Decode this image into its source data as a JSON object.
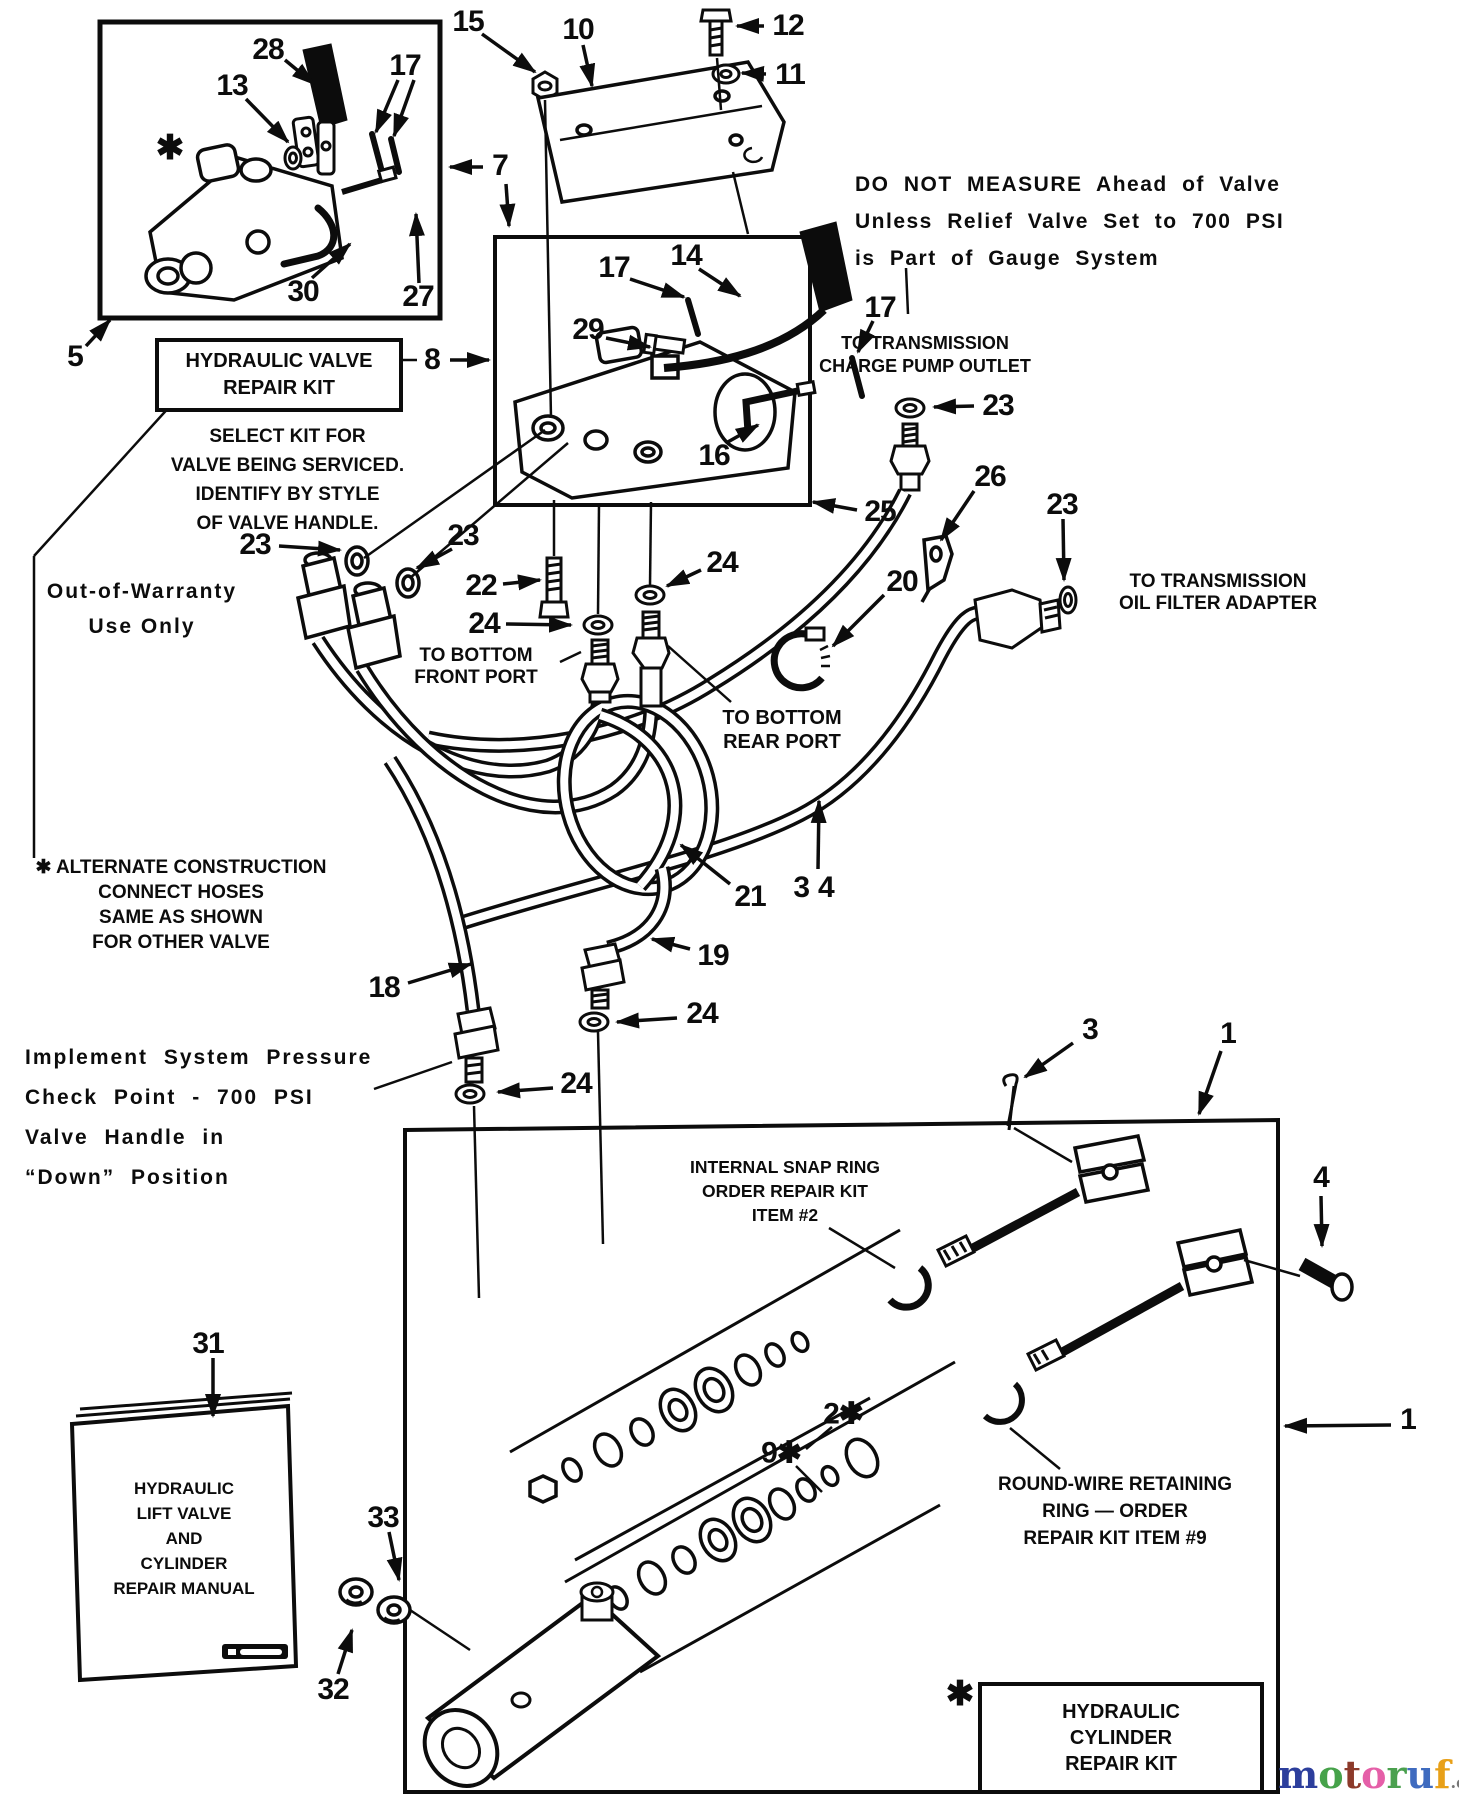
{
  "notes": {
    "do_not_measure": [
      "DO NOT MEASURE Ahead of Valve",
      "Unless Relief Valve Set to 700 PSI",
      "is Part of Gauge System"
    ],
    "charge_pump": [
      "TO TRANSMISSION",
      "CHARGE PUMP OUTLET"
    ],
    "oil_filter": [
      "TO TRANSMISSION",
      "OIL FILTER ADAPTER"
    ],
    "front_port": [
      "TO BOTTOM",
      "FRONT PORT"
    ],
    "rear_port": [
      "TO BOTTOM",
      "REAR PORT"
    ],
    "select_kit": [
      "SELECT KIT FOR",
      "VALVE BEING SERVICED.",
      "IDENTIFY BY STYLE",
      "OF VALVE HANDLE."
    ],
    "alternate": [
      "✱ ALTERNATE CONSTRUCTION",
      "CONNECT HOSES",
      "SAME AS SHOWN",
      "FOR OTHER VALVE"
    ],
    "out_of_warranty": [
      "Out-of-Warranty",
      "Use Only"
    ],
    "implement": [
      "Implement System Pressure",
      "Check Point - 700 PSI",
      "Valve Handle in",
      "“Down” Position"
    ],
    "snap_ring": [
      "INTERNAL SNAP RING",
      "ORDER REPAIR KIT",
      "ITEM #2"
    ],
    "round_wire": [
      "ROUND-WIRE RETAINING",
      "RING — ORDER",
      "REPAIR KIT ITEM #9"
    ]
  },
  "boxes": {
    "valve_repair_kit": [
      "HYDRAULIC VALVE",
      "REPAIR KIT"
    ],
    "cylinder_repair_kit": [
      "HYDRAULIC",
      "CYLINDER",
      "REPAIR KIT"
    ],
    "manual": [
      "HYDRAULIC",
      "LIFT VALVE",
      "AND",
      "CYLINDER",
      "REPAIR MANUAL"
    ]
  },
  "watermark": {
    "suffix": ".de",
    "letters": [
      {
        "ch": "m",
        "color": "#2c3e9c"
      },
      {
        "ch": "o",
        "color": "#46a24a"
      },
      {
        "ch": "t",
        "color": "#8c3a2a"
      },
      {
        "ch": "o",
        "color": "#e55fa8"
      },
      {
        "ch": "r",
        "color": "#4aa04e"
      },
      {
        "ch": "u",
        "color": "#3f6bbf"
      },
      {
        "ch": "f",
        "color": "#e8a018"
      }
    ]
  },
  "part_labels": [
    {
      "t": "28",
      "x": 268,
      "y": 50
    },
    {
      "t": "13",
      "x": 232,
      "y": 86
    },
    {
      "t": "17",
      "x": 405,
      "y": 66
    },
    {
      "t": "✱",
      "x": 170,
      "y": 148,
      "big": true
    },
    {
      "t": "30",
      "x": 303,
      "y": 292
    },
    {
      "t": "27",
      "x": 418,
      "y": 297
    },
    {
      "t": "5",
      "x": 75,
      "y": 357
    },
    {
      "t": "15",
      "x": 468,
      "y": 22
    },
    {
      "t": "10",
      "x": 578,
      "y": 30
    },
    {
      "t": "12",
      "x": 788,
      "y": 26
    },
    {
      "t": "11",
      "x": 790,
      "y": 75
    },
    {
      "t": "7",
      "x": 500,
      "y": 166
    },
    {
      "t": "8",
      "x": 432,
      "y": 360
    },
    {
      "t": "17",
      "x": 614,
      "y": 268
    },
    {
      "t": "14",
      "x": 686,
      "y": 256
    },
    {
      "t": "17",
      "x": 880,
      "y": 308
    },
    {
      "t": "29",
      "x": 588,
      "y": 330
    },
    {
      "t": "16",
      "x": 714,
      "y": 456
    },
    {
      "t": "23",
      "x": 998,
      "y": 406
    },
    {
      "t": "23",
      "x": 255,
      "y": 545
    },
    {
      "t": "23",
      "x": 463,
      "y": 536
    },
    {
      "t": "22",
      "x": 481,
      "y": 586
    },
    {
      "t": "24",
      "x": 722,
      "y": 563
    },
    {
      "t": "24",
      "x": 484,
      "y": 624
    },
    {
      "t": "25",
      "x": 880,
      "y": 512
    },
    {
      "t": "26",
      "x": 990,
      "y": 477
    },
    {
      "t": "23",
      "x": 1062,
      "y": 505
    },
    {
      "t": "20",
      "x": 902,
      "y": 582
    },
    {
      "t": "21",
      "x": 750,
      "y": 897
    },
    {
      "t": "34",
      "x": 818,
      "y": 888,
      "ls": 8
    },
    {
      "t": "19",
      "x": 713,
      "y": 956
    },
    {
      "t": "18",
      "x": 384,
      "y": 988
    },
    {
      "t": "24",
      "x": 702,
      "y": 1014
    },
    {
      "t": "24",
      "x": 576,
      "y": 1084
    },
    {
      "t": "3",
      "x": 1090,
      "y": 1030
    },
    {
      "t": "1",
      "x": 1228,
      "y": 1034
    },
    {
      "t": "4",
      "x": 1321,
      "y": 1178
    },
    {
      "t": "1",
      "x": 1408,
      "y": 1420
    },
    {
      "t": "2✱",
      "x": 843,
      "y": 1414
    },
    {
      "t": "9✱",
      "x": 781,
      "y": 1453
    },
    {
      "t": "31",
      "x": 208,
      "y": 1344
    },
    {
      "t": "33",
      "x": 383,
      "y": 1518
    },
    {
      "t": "32",
      "x": 333,
      "y": 1690
    },
    {
      "t": "✱",
      "x": 960,
      "y": 1694,
      "big": true
    }
  ],
  "leaders": {
    "arrows": [
      {
        "x1": 285,
        "y1": 60,
        "x2": 314,
        "y2": 84
      },
      {
        "x1": 246,
        "y1": 99,
        "x2": 288,
        "y2": 142
      },
      {
        "x1": 398,
        "y1": 80,
        "x2": 376,
        "y2": 132
      },
      {
        "x1": 414,
        "y1": 80,
        "x2": 394,
        "y2": 136
      },
      {
        "x1": 312,
        "y1": 278,
        "x2": 350,
        "y2": 244
      },
      {
        "x1": 419,
        "y1": 283,
        "x2": 416,
        "y2": 214
      },
      {
        "x1": 86,
        "y1": 346,
        "x2": 110,
        "y2": 320
      },
      {
        "x1": 482,
        "y1": 34,
        "x2": 535,
        "y2": 72
      },
      {
        "x1": 583,
        "y1": 45,
        "x2": 592,
        "y2": 86
      },
      {
        "x1": 764,
        "y1": 26,
        "x2": 737,
        "y2": 26
      },
      {
        "x1": 766,
        "y1": 74,
        "x2": 742,
        "y2": 73
      },
      {
        "x1": 483,
        "y1": 167,
        "x2": 450,
        "y2": 167
      },
      {
        "x1": 506,
        "y1": 184,
        "x2": 509,
        "y2": 226
      },
      {
        "x1": 450,
        "y1": 360,
        "x2": 489,
        "y2": 360
      },
      {
        "x1": 630,
        "y1": 279,
        "x2": 684,
        "y2": 297
      },
      {
        "x1": 699,
        "y1": 269,
        "x2": 740,
        "y2": 296
      },
      {
        "x1": 873,
        "y1": 321,
        "x2": 858,
        "y2": 352
      },
      {
        "x1": 606,
        "y1": 338,
        "x2": 650,
        "y2": 347
      },
      {
        "x1": 726,
        "y1": 443,
        "x2": 758,
        "y2": 425
      },
      {
        "x1": 974,
        "y1": 406,
        "x2": 934,
        "y2": 407
      },
      {
        "x1": 279,
        "y1": 546,
        "x2": 340,
        "y2": 550
      },
      {
        "x1": 452,
        "y1": 549,
        "x2": 417,
        "y2": 568
      },
      {
        "x1": 503,
        "y1": 584,
        "x2": 540,
        "y2": 580
      },
      {
        "x1": 701,
        "y1": 570,
        "x2": 667,
        "y2": 586
      },
      {
        "x1": 506,
        "y1": 624,
        "x2": 571,
        "y2": 625
      },
      {
        "x1": 857,
        "y1": 510,
        "x2": 813,
        "y2": 502
      },
      {
        "x1": 974,
        "y1": 491,
        "x2": 941,
        "y2": 540
      },
      {
        "x1": 1063,
        "y1": 519,
        "x2": 1064,
        "y2": 580
      },
      {
        "x1": 884,
        "y1": 595,
        "x2": 833,
        "y2": 646
      },
      {
        "x1": 730,
        "y1": 884,
        "x2": 681,
        "y2": 845
      },
      {
        "x1": 818,
        "y1": 869,
        "x2": 819,
        "y2": 801
      },
      {
        "x1": 690,
        "y1": 949,
        "x2": 652,
        "y2": 939
      },
      {
        "x1": 408,
        "y1": 983,
        "x2": 471,
        "y2": 964
      },
      {
        "x1": 677,
        "y1": 1018,
        "x2": 617,
        "y2": 1022
      },
      {
        "x1": 553,
        "y1": 1088,
        "x2": 498,
        "y2": 1092
      },
      {
        "x1": 1073,
        "y1": 1043,
        "x2": 1025,
        "y2": 1077
      },
      {
        "x1": 1221,
        "y1": 1051,
        "x2": 1199,
        "y2": 1114
      },
      {
        "x1": 1391,
        "y1": 1425,
        "x2": 1285,
        "y2": 1426
      },
      {
        "x1": 1321,
        "y1": 1196,
        "x2": 1322,
        "y2": 1246
      },
      {
        "x1": 213,
        "y1": 1358,
        "x2": 213,
        "y2": 1416
      },
      {
        "x1": 389,
        "y1": 1532,
        "x2": 399,
        "y2": 1580
      },
      {
        "x1": 338,
        "y1": 1674,
        "x2": 352,
        "y2": 1630
      }
    ],
    "lines": [
      {
        "x1": 545,
        "y1": 100,
        "x2": 551,
        "y2": 418
      },
      {
        "x1": 717,
        "y1": 58,
        "x2": 721,
        "y2": 110
      },
      {
        "x1": 733,
        "y1": 172,
        "x2": 748,
        "y2": 234
      },
      {
        "x1": 906,
        "y1": 268,
        "x2": 908,
        "y2": 314
      },
      {
        "x1": 172,
        "y1": 404,
        "x2": 34,
        "y2": 556
      },
      {
        "x1": 34,
        "y1": 556,
        "x2": 34,
        "y2": 858
      },
      {
        "x1": 397,
        "y1": 360,
        "x2": 417,
        "y2": 360
      },
      {
        "x1": 545,
        "y1": 430,
        "x2": 364,
        "y2": 558
      },
      {
        "x1": 568,
        "y1": 443,
        "x2": 410,
        "y2": 578
      },
      {
        "x1": 554,
        "y1": 500,
        "x2": 554,
        "y2": 556
      },
      {
        "x1": 599,
        "y1": 505,
        "x2": 598,
        "y2": 614
      },
      {
        "x1": 651,
        "y1": 502,
        "x2": 650,
        "y2": 586
      },
      {
        "x1": 560,
        "y1": 662,
        "x2": 581,
        "y2": 652
      },
      {
        "x1": 731,
        "y1": 702,
        "x2": 668,
        "y2": 646
      },
      {
        "x1": 374,
        "y1": 1089,
        "x2": 452,
        "y2": 1062
      },
      {
        "x1": 598,
        "y1": 1032,
        "x2": 603,
        "y2": 1244
      },
      {
        "x1": 474,
        "y1": 1106,
        "x2": 479,
        "y2": 1298
      },
      {
        "x1": 829,
        "y1": 1228,
        "x2": 895,
        "y2": 1268
      },
      {
        "x1": 1060,
        "y1": 1469,
        "x2": 1010,
        "y2": 1428
      },
      {
        "x1": 832,
        "y1": 1427,
        "x2": 806,
        "y2": 1449
      },
      {
        "x1": 796,
        "y1": 1466,
        "x2": 822,
        "y2": 1492
      },
      {
        "x1": 1014,
        "y1": 1128,
        "x2": 1072,
        "y2": 1162
      },
      {
        "x1": 1244,
        "y1": 1260,
        "x2": 1300,
        "y2": 1276
      },
      {
        "x1": 410,
        "y1": 1610,
        "x2": 470,
        "y2": 1650
      }
    ]
  }
}
